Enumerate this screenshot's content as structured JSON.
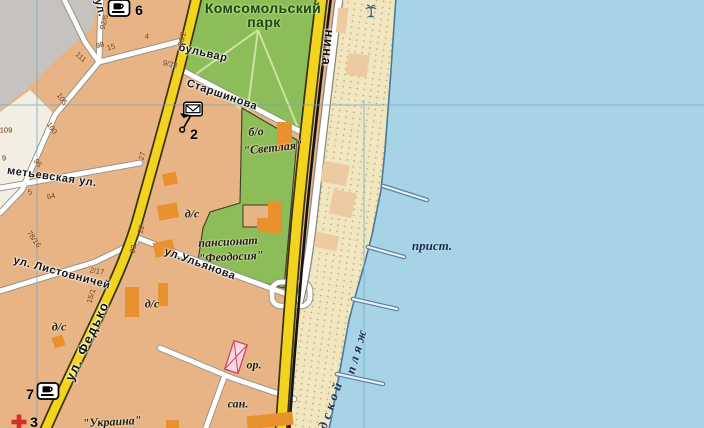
{
  "map_region": "city coastal map fragment",
  "colors": {
    "block_tan": "#e8b485",
    "park_green": "#8cbd58",
    "sea_blue": "#a6d3e6",
    "sand": "#f0e6c0",
    "road_yellow": "#f2d31e",
    "railway_black": "#141414",
    "grid_blue": "#6ea5cd",
    "building_orange": "#e8912e",
    "beach_building": "#eecaa2",
    "landmark_pink": "#cc4466",
    "grey_block": "#c6c2bf",
    "cream_block": "#f2eee3"
  },
  "labels": [
    {
      "name": "park-name-line1",
      "text": "Комсомольский",
      "x": 263,
      "y": 8,
      "rot": 0,
      "cls": "park"
    },
    {
      "name": "park-name-line2",
      "text": "парк",
      "x": 264,
      "y": 22,
      "rot": 0,
      "cls": "park"
    },
    {
      "name": "street-bulvar",
      "text": "бульвар",
      "x": 203,
      "y": 53,
      "rot": 13,
      "cls": "street"
    },
    {
      "name": "street-starshinova",
      "text": "Старшинова",
      "x": 222,
      "y": 95,
      "rot": 19,
      "cls": "street"
    },
    {
      "name": "street-ulyanova",
      "text": "ул.Ульянова",
      "x": 200,
      "y": 264,
      "rot": 20,
      "cls": "street"
    },
    {
      "name": "street-listovnichey",
      "text": "ул. Листовничей",
      "x": 62,
      "y": 273,
      "rot": 15,
      "cls": "street"
    },
    {
      "name": "street-metyevskaya",
      "text": "метьевская ул.",
      "x": 52,
      "y": 177,
      "rot": 8,
      "cls": "street"
    },
    {
      "name": "street-fedko",
      "text": "ул. Федько",
      "x": 87,
      "y": 341,
      "rot": -65,
      "cls": "street-lg"
    },
    {
      "name": "street-lenina",
      "text": "нина",
      "x": 328,
      "y": 48,
      "rot": 96,
      "cls": "street-lg"
    },
    {
      "name": "street-ul-top",
      "text": "ул.",
      "x": 100,
      "y": 8,
      "rot": 76,
      "cls": "street"
    },
    {
      "name": "bo-svetlaya-line1",
      "text": "б/о",
      "x": 256,
      "y": 132,
      "rot": -4,
      "cls": "obj"
    },
    {
      "name": "bo-svetlaya-line2",
      "text": "\"Светлая\"",
      "x": 273,
      "y": 148,
      "rot": -6,
      "cls": "obj"
    },
    {
      "name": "pansionat-line1",
      "text": "пансионат",
      "x": 228,
      "y": 242,
      "rot": -3,
      "cls": "obj"
    },
    {
      "name": "pansionat-line2",
      "text": "\"Феодосия\"",
      "x": 231,
      "y": 257,
      "rot": -3,
      "cls": "obj"
    },
    {
      "name": "kindergarten-1",
      "text": "д/с",
      "x": 192,
      "y": 214,
      "rot": 0,
      "cls": "obj"
    },
    {
      "name": "kindergarten-2",
      "text": "д/с",
      "x": 152,
      "y": 304,
      "rot": 0,
      "cls": "obj"
    },
    {
      "name": "kindergarten-3",
      "text": "д/с",
      "x": 59,
      "y": 327,
      "rot": 0,
      "cls": "obj"
    },
    {
      "name": "or-label",
      "text": "ор.",
      "x": 254,
      "y": 365,
      "rot": 0,
      "cls": "obj"
    },
    {
      "name": "san-label",
      "text": "сан.",
      "x": 238,
      "y": 404,
      "rot": 0,
      "cls": "obj"
    },
    {
      "name": "ukraina-label",
      "text": "\"Украина\"",
      "x": 112,
      "y": 422,
      "rot": -3,
      "cls": "obj"
    },
    {
      "name": "prist-label",
      "text": "прист.",
      "x": 432,
      "y": 246,
      "rot": 0,
      "cls": "sea"
    },
    {
      "name": "plyazh-label",
      "text": "пляж",
      "x": 357,
      "y": 350,
      "rot": -74,
      "cls": "sea sea-sp"
    },
    {
      "name": "gorodskoy-label",
      "text": "дской",
      "x": 331,
      "y": 404,
      "rot": -71,
      "cls": "sea sea-sp"
    }
  ],
  "poi_numbers": [
    {
      "text": "6",
      "x": 139,
      "y": 10
    },
    {
      "text": "2",
      "x": 194,
      "y": 134
    },
    {
      "text": "7",
      "x": 30,
      "y": 394
    },
    {
      "text": "3",
      "x": 34,
      "y": 422
    }
  ],
  "house_numbers": [
    {
      "text": "92/6",
      "x": 104,
      "y": 22,
      "rot": -76
    },
    {
      "text": "98",
      "x": 100,
      "y": 45,
      "rot": -15
    },
    {
      "text": "15",
      "x": 111,
      "y": 47,
      "rot": -15
    },
    {
      "text": "4",
      "x": 147,
      "y": 36,
      "rot": 0
    },
    {
      "text": "36/2",
      "x": 182,
      "y": 39,
      "rot": -76
    },
    {
      "text": "9/33",
      "x": 170,
      "y": 64,
      "rot": 12
    },
    {
      "text": "111",
      "x": 81,
      "y": 57,
      "rot": 42
    },
    {
      "text": "105",
      "x": 62,
      "y": 99,
      "rot": 55
    },
    {
      "text": "100",
      "x": 52,
      "y": 128,
      "rot": 55
    },
    {
      "text": "95",
      "x": 38,
      "y": 163,
      "rot": 55
    },
    {
      "text": "109",
      "x": 6,
      "y": 130,
      "rot": 0
    },
    {
      "text": "27",
      "x": 142,
      "y": 156,
      "rot": -76
    },
    {
      "text": "64",
      "x": 51,
      "y": 196,
      "rot": -12
    },
    {
      "text": "78/16",
      "x": 34,
      "y": 239,
      "rot": 55
    },
    {
      "text": "22",
      "x": 141,
      "y": 229,
      "rot": -76
    },
    {
      "text": "20",
      "x": 133,
      "y": 249,
      "rot": -76
    },
    {
      "text": "2/17",
      "x": 97,
      "y": 271,
      "rot": 10
    },
    {
      "text": "15/1",
      "x": 91,
      "y": 296,
      "rot": -72
    },
    {
      "text": "9",
      "x": 4,
      "y": 158,
      "rot": 0
    },
    {
      "text": "5",
      "x": 30,
      "y": 192,
      "rot": -12
    }
  ],
  "icons": [
    {
      "name": "cafe-icon",
      "type": "cafe",
      "x": 119,
      "y": 8
    },
    {
      "name": "cafe-icon",
      "type": "cafe",
      "x": 48,
      "y": 391
    },
    {
      "name": "post-office-envelope-icon",
      "type": "envelope",
      "x": 193,
      "y": 109
    },
    {
      "name": "monument-flag-icon",
      "type": "flag",
      "x": 186,
      "y": 123
    },
    {
      "name": "hospital-cross-icon",
      "type": "cross",
      "x": 19,
      "y": 422
    },
    {
      "name": "palm-tree-icon",
      "type": "palm",
      "x": 371,
      "y": 10
    }
  ],
  "buildings": [
    {
      "type": "building",
      "x": 163,
      "y": 173,
      "w": 14,
      "h": 12,
      "rot": -12
    },
    {
      "type": "building",
      "x": 158,
      "y": 204,
      "w": 20,
      "h": 15,
      "rot": -10
    },
    {
      "type": "building",
      "x": 154,
      "y": 241,
      "w": 20,
      "h": 15,
      "rot": -12
    },
    {
      "type": "building",
      "x": 125,
      "y": 287,
      "w": 14,
      "h": 30,
      "rot": 0
    },
    {
      "type": "building",
      "x": 158,
      "y": 283,
      "w": 10,
      "h": 23,
      "rot": 0
    },
    {
      "type": "building",
      "x": 53,
      "y": 336,
      "w": 11,
      "h": 11,
      "rot": -18
    },
    {
      "type": "building",
      "x": 277,
      "y": 122,
      "w": 15,
      "h": 28,
      "rot": 0
    },
    {
      "type": "building",
      "x": 268,
      "y": 202,
      "w": 14,
      "h": 31,
      "rot": 0
    },
    {
      "type": "building",
      "x": 257,
      "y": 218,
      "w": 12,
      "h": 14,
      "rot": 0
    },
    {
      "type": "building",
      "x": 247,
      "y": 414,
      "w": 46,
      "h": 13,
      "rot": -6
    },
    {
      "type": "building",
      "x": 166,
      "y": 420,
      "w": 13,
      "h": 8,
      "rot": 0
    },
    {
      "type": "beach-building",
      "x": 337,
      "y": 8,
      "w": 10,
      "h": 25,
      "rot": 6
    },
    {
      "type": "beach-building",
      "x": 347,
      "y": 54,
      "w": 21,
      "h": 22,
      "rot": 8
    },
    {
      "type": "beach-building",
      "x": 322,
      "y": 163,
      "w": 26,
      "h": 21,
      "rot": 10
    },
    {
      "type": "beach-building",
      "x": 331,
      "y": 191,
      "w": 23,
      "h": 25,
      "rot": 12
    },
    {
      "type": "beach-building",
      "x": 315,
      "y": 234,
      "w": 23,
      "h": 15,
      "rot": 12
    },
    {
      "type": "landmark",
      "x": 229,
      "y": 342,
      "w": 14,
      "h": 30,
      "rot": 18
    }
  ],
  "piers": [
    {
      "x1": 383,
      "y1": 186,
      "x2": 427,
      "y2": 200
    },
    {
      "x1": 368,
      "y1": 247,
      "x2": 404,
      "y2": 257
    },
    {
      "x1": 353,
      "y1": 299,
      "x2": 397,
      "y2": 309
    },
    {
      "x1": 337,
      "y1": 374,
      "x2": 383,
      "y2": 384
    }
  ]
}
